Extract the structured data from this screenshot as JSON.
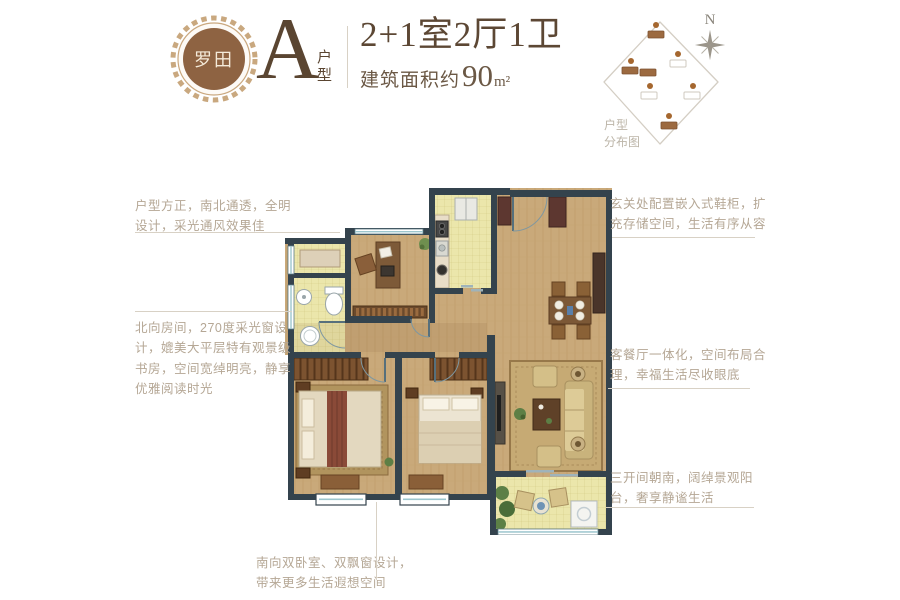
{
  "header": {
    "badge_text": "罗田",
    "unit_letter": "A",
    "unit_label_top": "户",
    "unit_label_bottom": "型",
    "title": "2+1室2厅1卫",
    "area_prefix": "建筑面积约",
    "area_value": "90",
    "area_unit": "m²"
  },
  "sitemap": {
    "compass_label": "N",
    "caption_line1": "户型",
    "caption_line2": "分布图"
  },
  "annotations": {
    "left_top": "户型方正，南北通透，全明\n设计，采光通风效果佳",
    "left_middle": "北向房间，270度采光窗设\n计，媲美大平层特有观景级\n书房，空间宽绰明亮，静享\n优雅阅读时光",
    "right_top": "玄关处配置嵌入式鞋柜，扩\n充存储空间，生活有序从容",
    "right_middle": "客餐厅一体化，空间布局合\n理，幸福生活尽收眼底",
    "right_bottom": "三开间朝南，阔绰景观阳\n台，奢享静谧生活",
    "bottom": "南向双卧室、双飘窗设计，\n带来更多生活遐想空间"
  },
  "colors": {
    "brand_brown": "#8e6342",
    "header_text": "#5c4734",
    "annotation_text": "#b5a795",
    "wall": "#34434d",
    "wood_floor": "#c9a97a",
    "tile_floor": "#ebe6ab"
  }
}
